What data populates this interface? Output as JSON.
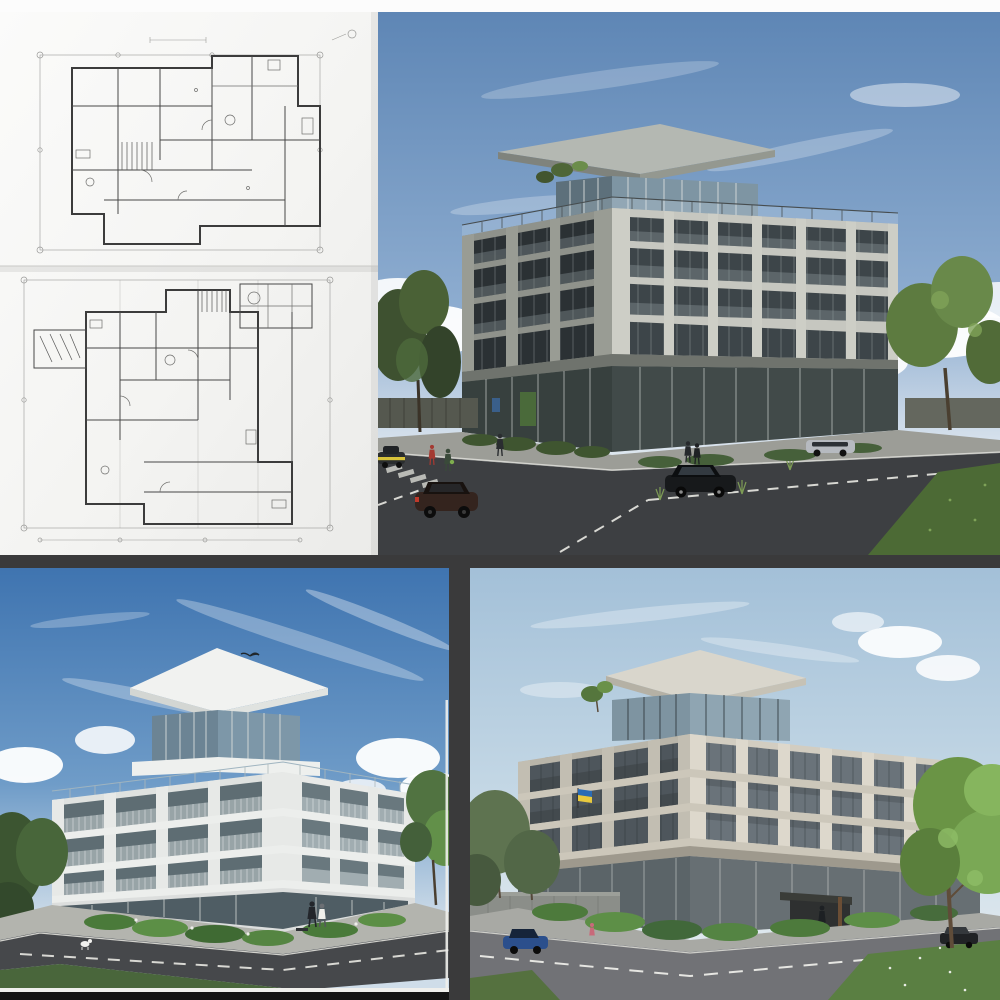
{
  "collage": {
    "title": "Architectural design collage — drafted floor plans with three exterior renders of a modern 4–5 storey corner apartment building",
    "grid": "2x2 image grid",
    "panels": {
      "floor_plan": {
        "position": "top-left",
        "description": "Hand-drafted pencil floor plans on white paper: two storey plans stacked vertically with dimension lines, grid-bubble markers, stair hatching and tiny illegible drafting annotations"
      },
      "render_grey": {
        "position": "top-right",
        "description": "Street-corner render of a grey stone and glass five-storey building with a cantilevered flat penthouse roof, rooftop glass railing, retail glass ground floor, pedestrians, parked cars, a taxi and flanking trees under a blue sky with wispy clouds"
      },
      "render_white": {
        "position": "bottom-left",
        "description": "Render of the same massing as a white concrete building with open corner balconies, glass penthouse under an overhanging white roof slab, landscaped street corner with shrubs, two people by the entrance, a small white dog and a bird in the deep blue sky"
      },
      "render_beige": {
        "position": "bottom-right",
        "description": "Render of a beige stone variant with rooftop terrace and overhanging roof, a small blue-and-yellow flag on the facade, dark entrance canopy, parked blue and black cars, hedges and a large sunlit tree under a pale sky"
      }
    }
  },
  "colors": {
    "top_band": "#fcfcfc",
    "divider": "#3a3a3b",
    "frame_black": "#141414",
    "frame_white": "#efefec",
    "paper": "#f4f4f2",
    "ink": "#3c3c3c",
    "ink_light": "#9a9a98",
    "r1_sky_top": "#5e86b5",
    "r1_sky_low": "#e8eef3",
    "r1_stone_light": "#c6c7c0",
    "r1_stone_shadow": "#8f928b",
    "r1_glass_dark": "#2b3134",
    "r1_glass_right": "#3d4549",
    "r1_roof": "#b4b8b2",
    "road_dark": "#3d3f42",
    "sidewalk": "#9c9d97",
    "green_dark": "#42552f",
    "green_light": "#6b8d4a",
    "grass": "#4c6a35",
    "r2_sky_top": "#3f74b0",
    "r2_sky_low": "#cfdde9",
    "r2_white": "#e9eae8",
    "r2_white_shadow": "#dfe2e0",
    "r2_glass": "#5e6d73",
    "r2_rail": "#a7b2b5",
    "r3_sky_top": "#a3c0d8",
    "r3_sky_low": "#e2eaef",
    "r3_stone": "#d2cdc1",
    "r3_stone_shadow": "#b9b5a9",
    "r3_glass": "#4e565c",
    "r3_road": "#717276",
    "taxi_yellow": "#d8c33a",
    "car_blue": "#2b4f8c",
    "tail_red": "#c0392b",
    "flag_blue": "#2a6bb5",
    "flag_yellow": "#e8c93e"
  }
}
